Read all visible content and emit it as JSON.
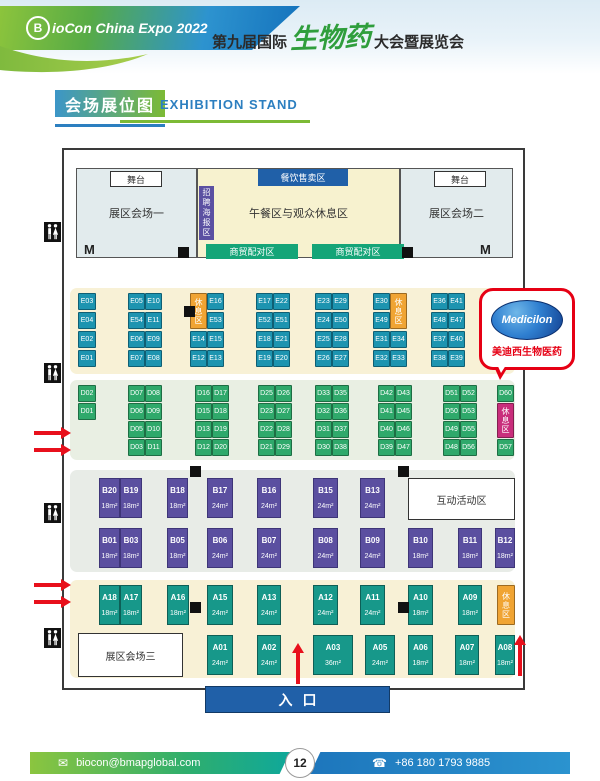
{
  "header": {
    "logo_letter": "B",
    "logo_text": "ioCon China Expo 2022",
    "title_prefix": "第九届国际",
    "title_highlight": "生物药",
    "title_suffix": "大会暨展览会"
  },
  "section": {
    "title_cn": "会场展位图",
    "title_en": "EXHIBITION STAND"
  },
  "bubble": {
    "logo_text": "Medicilon",
    "caption": "美迪西生物医药"
  },
  "entrance": {
    "label": "入口"
  },
  "footer": {
    "email_icon": "✉",
    "email": "biocon@bmapglobal.com",
    "page": "12",
    "phone_icon": "☎",
    "phone": "+86 180 1793 9885"
  },
  "map": {
    "bands": [
      {
        "name": "e-booth-band",
        "x": 70,
        "y": 288,
        "w": 445,
        "h": 86,
        "bg": "#f8f1d6"
      },
      {
        "name": "d-booth-band",
        "x": 70,
        "y": 380,
        "w": 445,
        "h": 80,
        "bg": "#e9efe3"
      },
      {
        "name": "b-booth-band",
        "x": 70,
        "y": 470,
        "w": 445,
        "h": 102,
        "bg": "#e8ece7"
      },
      {
        "name": "a-booth-band",
        "x": 70,
        "y": 580,
        "w": 445,
        "h": 98,
        "bg": "#f8f1d6"
      }
    ],
    "zones": [
      {
        "name": "hall-1",
        "label": "展区会场一",
        "x": 76,
        "y": 168,
        "w": 121,
        "h": 90,
        "bg": "#e2ebed",
        "border": "#555",
        "fs": 11
      },
      {
        "name": "lunch-rest-area",
        "label": "午餐区与观众休息区",
        "x": 197,
        "y": 168,
        "w": 203,
        "h": 90,
        "bg": "#f7f2cf",
        "border": "#555",
        "fs": 11
      },
      {
        "name": "hall-2",
        "label": "展区会场二",
        "x": 400,
        "y": 168,
        "w": 113,
        "h": 90,
        "bg": "#e2ebed",
        "border": "#555",
        "fs": 11
      },
      {
        "name": "stage-1",
        "label": "舞台",
        "x": 110,
        "y": 171,
        "w": 52,
        "h": 16,
        "bg": "#ffffff",
        "border": "#333",
        "fs": 9
      },
      {
        "name": "stage-2",
        "label": "舞台",
        "x": 434,
        "y": 171,
        "w": 52,
        "h": 16,
        "bg": "#ffffff",
        "border": "#333",
        "fs": 9
      },
      {
        "name": "food-sales-area",
        "label": "餐饮售卖区",
        "x": 258,
        "y": 169,
        "w": 90,
        "h": 17,
        "bg": "#2060a8",
        "fg": "#ffffff",
        "fs": 9
      },
      {
        "name": "poster-area",
        "label": "招聘海报区",
        "x": 199,
        "y": 186,
        "w": 15,
        "h": 54,
        "bg": "#5b50a2",
        "fg": "#ffffff",
        "fs": 8,
        "vertical": true
      },
      {
        "name": "business-matching-area-1",
        "label": "商贸配对区",
        "x": 206,
        "y": 244,
        "w": 92,
        "h": 15,
        "bg": "#15a578",
        "fg": "#ffffff",
        "fs": 9
      },
      {
        "name": "business-matching-area-2",
        "label": "商贸配对区",
        "x": 312,
        "y": 244,
        "w": 92,
        "h": 15,
        "bg": "#15a578",
        "fg": "#ffffff",
        "fs": 9
      },
      {
        "name": "interactive-activity-area",
        "label": "互动活动区",
        "x": 408,
        "y": 478,
        "w": 107,
        "h": 42,
        "bg": "#ffffff",
        "border": "#333",
        "fs": 10
      },
      {
        "name": "hall-3",
        "label": "展区会场三",
        "x": 78,
        "y": 633,
        "w": 105,
        "h": 44,
        "bg": "#ffffff",
        "border": "#333",
        "fs": 10
      }
    ],
    "rest_blocks": [
      {
        "label": "休息区",
        "x": 190,
        "y": 293,
        "w": 17,
        "h": 36,
        "bg": "#f0a433"
      },
      {
        "label": "休息区",
        "x": 390,
        "y": 293,
        "w": 17,
        "h": 36,
        "bg": "#f0a433"
      },
      {
        "label": "休息区",
        "x": 497,
        "y": 403,
        "w": 17,
        "h": 35,
        "bg": "#c92e7c"
      },
      {
        "label": "休息区",
        "x": 497,
        "y": 585,
        "w": 18,
        "h": 40,
        "bg": "#f0a433"
      }
    ],
    "e_booths": [
      [
        "E03",
        78,
        293,
        18
      ],
      [
        "E04",
        78,
        312,
        18
      ],
      [
        "E02",
        78,
        331,
        18
      ],
      [
        "E01",
        78,
        350,
        18
      ],
      [
        "E05",
        128,
        293,
        17
      ],
      [
        "E10",
        145,
        293,
        17
      ],
      [
        "E54",
        128,
        312,
        17
      ],
      [
        "E11",
        145,
        312,
        17
      ],
      [
        "E06",
        128,
        331,
        17
      ],
      [
        "E09",
        145,
        331,
        17
      ],
      [
        "E07",
        128,
        350,
        17
      ],
      [
        "E08",
        145,
        350,
        17
      ],
      [
        "E16",
        207,
        293,
        17
      ],
      [
        "E53",
        207,
        312,
        17
      ],
      [
        "E14",
        190,
        331,
        17
      ],
      [
        "E15",
        207,
        331,
        17
      ],
      [
        "E12",
        190,
        350,
        17
      ],
      [
        "E13",
        207,
        350,
        17
      ],
      [
        "E17",
        256,
        293,
        17
      ],
      [
        "E22",
        273,
        293,
        17
      ],
      [
        "E52",
        256,
        312,
        17
      ],
      [
        "E51",
        273,
        312,
        17
      ],
      [
        "E18",
        256,
        331,
        17
      ],
      [
        "E21",
        273,
        331,
        17
      ],
      [
        "E19",
        256,
        350,
        17
      ],
      [
        "E20",
        273,
        350,
        17
      ],
      [
        "E23",
        315,
        293,
        17
      ],
      [
        "E29",
        332,
        293,
        17
      ],
      [
        "E24",
        315,
        312,
        17
      ],
      [
        "E50",
        332,
        312,
        17
      ],
      [
        "E25",
        315,
        331,
        17
      ],
      [
        "E28",
        332,
        331,
        17
      ],
      [
        "E26",
        315,
        350,
        17
      ],
      [
        "E27",
        332,
        350,
        17
      ],
      [
        "E30",
        373,
        293,
        17
      ],
      [
        "E49",
        373,
        312,
        17
      ],
      [
        "E31",
        373,
        331,
        17
      ],
      [
        "E34",
        390,
        331,
        17
      ],
      [
        "E32",
        373,
        350,
        17
      ],
      [
        "E33",
        390,
        350,
        17
      ],
      [
        "E36",
        431,
        293,
        17
      ],
      [
        "E41",
        448,
        293,
        17
      ],
      [
        "E48",
        431,
        312,
        17
      ],
      [
        "E47",
        448,
        312,
        17
      ],
      [
        "E37",
        431,
        331,
        17
      ],
      [
        "E40",
        448,
        331,
        17
      ],
      [
        "E38",
        431,
        350,
        17
      ],
      [
        "E39",
        448,
        350,
        17
      ]
    ],
    "d_booths": [
      [
        "D02",
        78,
        385,
        18
      ],
      [
        "D01",
        78,
        403,
        18
      ],
      [
        "D07",
        128,
        385,
        17
      ],
      [
        "D08",
        145,
        385,
        17
      ],
      [
        "D06",
        128,
        403,
        17
      ],
      [
        "D09",
        145,
        403,
        17
      ],
      [
        "D05",
        128,
        421,
        17
      ],
      [
        "D10",
        145,
        421,
        17
      ],
      [
        "D03",
        128,
        439,
        17
      ],
      [
        "D11",
        145,
        439,
        17
      ],
      [
        "D16",
        195,
        385,
        17
      ],
      [
        "D17",
        212,
        385,
        17
      ],
      [
        "D15",
        195,
        403,
        17
      ],
      [
        "D18",
        212,
        403,
        17
      ],
      [
        "D13",
        195,
        421,
        17
      ],
      [
        "D19",
        212,
        421,
        17
      ],
      [
        "D12",
        195,
        439,
        17
      ],
      [
        "D20",
        212,
        439,
        17
      ],
      [
        "D25",
        258,
        385,
        17
      ],
      [
        "D26",
        275,
        385,
        17
      ],
      [
        "D23",
        258,
        403,
        17
      ],
      [
        "D27",
        275,
        403,
        17
      ],
      [
        "D22",
        258,
        421,
        17
      ],
      [
        "D28",
        275,
        421,
        17
      ],
      [
        "D21",
        258,
        439,
        17
      ],
      [
        "D29",
        275,
        439,
        17
      ],
      [
        "D33",
        315,
        385,
        17
      ],
      [
        "D35",
        332,
        385,
        17
      ],
      [
        "D32",
        315,
        403,
        17
      ],
      [
        "D36",
        332,
        403,
        17
      ],
      [
        "D31",
        315,
        421,
        17
      ],
      [
        "D37",
        332,
        421,
        17
      ],
      [
        "D30",
        315,
        439,
        17
      ],
      [
        "D38",
        332,
        439,
        17
      ],
      [
        "D42",
        378,
        385,
        17
      ],
      [
        "D43",
        395,
        385,
        17
      ],
      [
        "D41",
        378,
        403,
        17
      ],
      [
        "D45",
        395,
        403,
        17
      ],
      [
        "D40",
        378,
        421,
        17
      ],
      [
        "D46",
        395,
        421,
        17
      ],
      [
        "D39",
        378,
        439,
        17
      ],
      [
        "D47",
        395,
        439,
        17
      ],
      [
        "D51",
        443,
        385,
        17
      ],
      [
        "D52",
        460,
        385,
        17
      ],
      [
        "D50",
        443,
        403,
        17
      ],
      [
        "D53",
        460,
        403,
        17
      ],
      [
        "D49",
        443,
        421,
        17
      ],
      [
        "D55",
        460,
        421,
        17
      ],
      [
        "D48",
        443,
        439,
        17
      ],
      [
        "D56",
        460,
        439,
        17
      ],
      [
        "D60",
        497,
        385,
        17
      ],
      [
        "D57",
        497,
        439,
        17
      ]
    ],
    "b_booths": [
      [
        "B20",
        "18m²",
        99,
        478,
        21
      ],
      [
        "B19",
        "18m²",
        120,
        478,
        22
      ],
      [
        "B18",
        "18m²",
        167,
        478,
        21
      ],
      [
        "B17",
        "24m²",
        207,
        478,
        26
      ],
      [
        "B16",
        "24m²",
        257,
        478,
        24
      ],
      [
        "B15",
        "24m²",
        313,
        478,
        25
      ],
      [
        "B13",
        "24m²",
        360,
        478,
        25
      ],
      [
        "B01",
        "18m²",
        99,
        528,
        21
      ],
      [
        "B03",
        "18m²",
        120,
        528,
        22
      ],
      [
        "B05",
        "18m²",
        167,
        528,
        21
      ],
      [
        "B06",
        "24m²",
        207,
        528,
        26
      ],
      [
        "B07",
        "24m²",
        257,
        528,
        24
      ],
      [
        "B08",
        "24m²",
        313,
        528,
        25
      ],
      [
        "B09",
        "24m²",
        360,
        528,
        25
      ],
      [
        "B10",
        "18m²",
        408,
        528,
        25
      ],
      [
        "B11",
        "18m²",
        458,
        528,
        24
      ],
      [
        "B12",
        "18m²",
        495,
        528,
        20
      ]
    ],
    "a_booths": [
      [
        "A18",
        "18m²",
        99,
        585,
        21
      ],
      [
        "A17",
        "18m²",
        120,
        585,
        22
      ],
      [
        "A16",
        "18m²",
        167,
        585,
        22
      ],
      [
        "A15",
        "24m²",
        207,
        585,
        26
      ],
      [
        "A13",
        "24m²",
        257,
        585,
        24
      ],
      [
        "A12",
        "24m²",
        313,
        585,
        25
      ],
      [
        "A11",
        "24m²",
        360,
        585,
        25
      ],
      [
        "A10",
        "18m²",
        408,
        585,
        25
      ],
      [
        "A09",
        "18m²",
        458,
        585,
        24
      ],
      [
        "A01",
        "24m²",
        207,
        635,
        26
      ],
      [
        "A02",
        "24m²",
        257,
        635,
        24
      ],
      [
        "A03",
        "36m²",
        313,
        635,
        40
      ],
      [
        "A05",
        "24m²",
        365,
        635,
        30
      ],
      [
        "A06",
        "18m²",
        408,
        635,
        25
      ],
      [
        "A07",
        "18m²",
        455,
        635,
        24
      ],
      [
        "A08",
        "18m²",
        495,
        635,
        20
      ]
    ],
    "pillars": [
      [
        178,
        247
      ],
      [
        402,
        247
      ],
      [
        184,
        306
      ],
      [
        190,
        466
      ],
      [
        398,
        466
      ],
      [
        190,
        602
      ],
      [
        398,
        602
      ]
    ],
    "doors": [
      [
        84,
        243
      ],
      [
        480,
        243
      ]
    ],
    "toilets": [
      [
        44,
        222
      ],
      [
        44,
        363
      ],
      [
        44,
        503
      ],
      [
        44,
        628
      ]
    ],
    "arrows": [
      {
        "dir": "right",
        "x": 34,
        "y": 431
      },
      {
        "dir": "right",
        "x": 34,
        "y": 448
      },
      {
        "dir": "right",
        "x": 34,
        "y": 583
      },
      {
        "dir": "right",
        "x": 34,
        "y": 600
      },
      {
        "dir": "up",
        "x": 296,
        "y": 652
      },
      {
        "dir": "up",
        "x": 518,
        "y": 644
      }
    ]
  }
}
